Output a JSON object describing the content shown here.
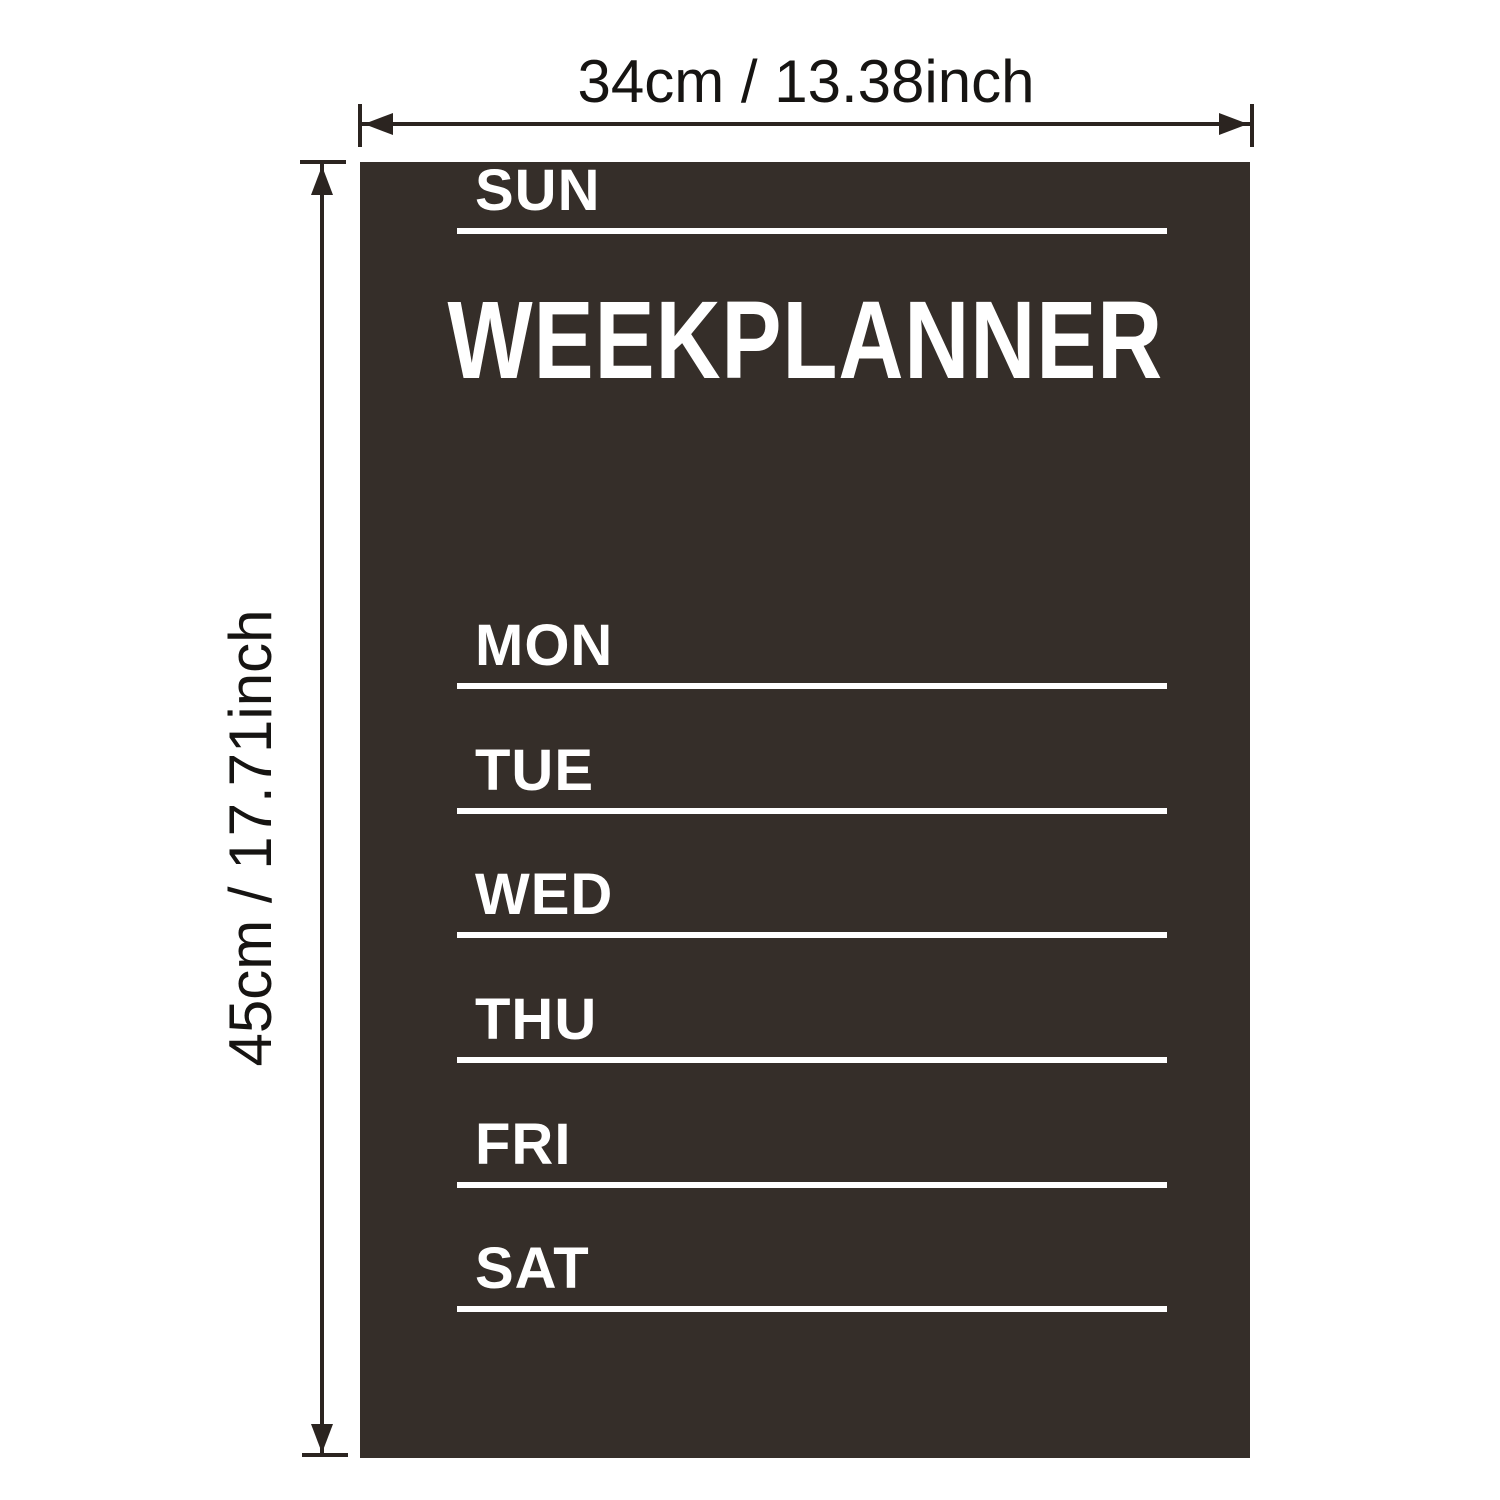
{
  "annotations": {
    "width_label": "34cm / 13.38inch",
    "height_label": "45cm / 17.71inch"
  },
  "board": {
    "title": "WEEKPLANNER",
    "days": [
      "MON",
      "TUE",
      "WED",
      "THU",
      "FRI",
      "SAT",
      "SUN"
    ],
    "bg_color": "#352e29",
    "fg_color": "#ffffff"
  },
  "colors": {
    "page_bg": "#ffffff",
    "annotation_line": "#2b2420",
    "annotation_text": "#161412"
  }
}
